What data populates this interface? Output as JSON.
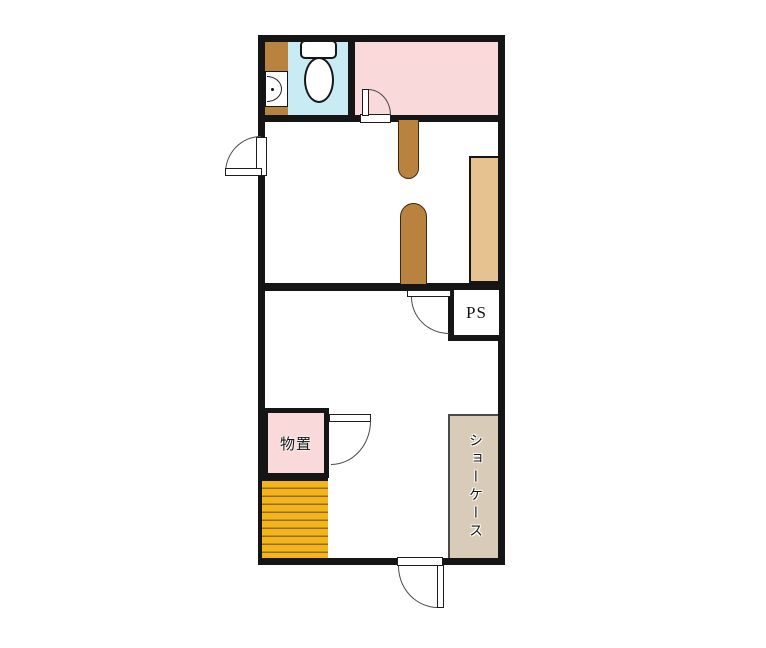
{
  "plan": {
    "labels": {
      "pipe_space": "PS",
      "storage": "物置",
      "showcase": "ショーケース"
    },
    "colors": {
      "background": "#ffffff",
      "wall": "#151515",
      "toilet_room_floor": "#c9ecf4",
      "upper_room": "#f9d9da",
      "storage_room": "#f9d9da",
      "wood_trim": "#b9823f",
      "counter": "#e5c28f",
      "showcase": "#d8ccb9",
      "stairs": "#f4b51c",
      "stair_step_line": "#926f12"
    }
  }
}
